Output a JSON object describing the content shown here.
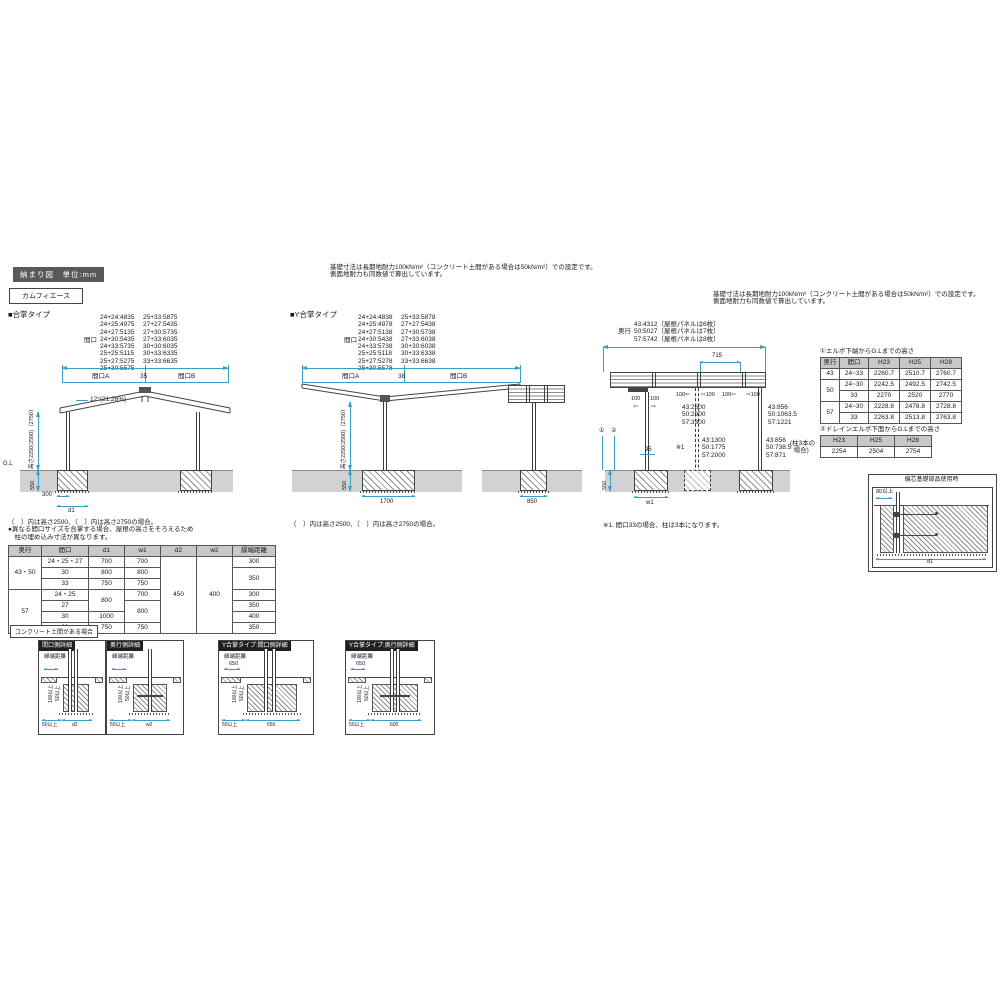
{
  "header": {
    "badge": "納まり図　単位:mm",
    "product": "カムフィエース"
  },
  "note_center": "基礎寸法は長期地耐力100kN/m²（コンクリート土間がある場合は50kN/m²）での設定です。\n側面地耐力も同数値で算出しています。",
  "note_right": "基礎寸法は長期地耐力100kN/m²（コンクリート土間がある場合は50kN/m²）での設定です。\n側面地耐力も同数値で算出しています。",
  "gassho": {
    "title": "■合掌タイプ",
    "maguchi": "間口",
    "col1": "24+24:4835\n24+25:4975\n24+27:5135\n24+30:5435\n24+33:5735\n25+25:5115\n25+27:5275\n25+30:5575",
    "col2": "25+33:5875\n27+27:5435\n27+30:5735\n27+33:6035\n30+30:6035\n30+33:6335\n33+33:6635",
    "span_a": "間口A",
    "gap": "35",
    "span_b": "間口B",
    "slope": "12°(21.26%)",
    "gl": "G.L",
    "height": "高さ2250(2500)〔2750〕",
    "d550": "550",
    "d300": "300",
    "d1": "d1",
    "note": "（　）内は高さ2500、〔　〕内は高さ2750の場合。\n●異なる間口サイズを合掌する場合、屋根の高さをそろえるため\n　柱の埋め込み寸法が異なります。"
  },
  "ygassho": {
    "title": "■Y合掌タイプ",
    "maguchi": "間口",
    "col1": "24+24:4838\n24+25:4978\n24+27:5138\n24+30:5438\n24+33:5738\n25+25:5118\n25+27:5278\n25+30:5578",
    "col2": "25+33:5878\n27+27:5438\n27+30:5738\n27+33:6038\n30+30:6038\n30+33:6338\n33+33:6638",
    "span_a": "間口A",
    "gap": "38",
    "span_b": "間口B",
    "height": "高さ2250(2500)〔2750〕",
    "d550": "550",
    "d1700": "1700",
    "d850": "850",
    "note": "（　）内は高さ2500、〔　〕内は高さ2750の場合。"
  },
  "depth": {
    "label": "奥行",
    "dims": "43:4312〔屋根パネルは6枚〕\n50:5027〔屋根パネルは7枚〕\n57:5742〔屋根パネルは8枚〕",
    "d715": "715",
    "a100l": "100",
    "a100r": "100",
    "arrow_l": "⇦",
    "arrow_r": "⇨",
    "joint1l": "100⇦",
    "joint1r": "⇨100",
    "joint2l": "100⇦",
    "joint2r": "⇨100",
    "span1": "43:2600\n50:2900\n57:3300",
    "post1": "43:856\n50:1063.5\n57:1221",
    "span2": "43:1300\n50:1775\n57:2000",
    "post2": "43:856\n50:738.5\n57:871",
    "three": "(柱3本の\n  場合)",
    "d95": "95",
    "ast": "※1",
    "ref1": "①",
    "ref2": "②",
    "d550": "550",
    "w1": "w1",
    "footnote": "※1. 間口33の場合、柱は3本になります。"
  },
  "table_elbow": {
    "title": "①エルボ下端からG.Lまでの高さ",
    "headers": [
      "奥行",
      "間口",
      "H23",
      "H25",
      "H28"
    ],
    "rows": [
      {
        "depth": "43",
        "span": "24~33",
        "h23": "2260.7",
        "h25": "2510.7",
        "h28": "2760.7"
      },
      {
        "depth": "50",
        "span": "24~30",
        "h23": "2242.5",
        "h25": "2492.5",
        "h28": "2742.5"
      },
      {
        "span": "33",
        "h23": "2270",
        "h25": "2520",
        "h28": "2770"
      },
      {
        "depth": "57",
        "span": "24~30",
        "h23": "2228.8",
        "h25": "2478.8",
        "h28": "2728.8"
      },
      {
        "span": "33",
        "h23": "2263.8",
        "h25": "2513.8",
        "h28": "2763.8"
      }
    ]
  },
  "table_drain": {
    "title": "②ドレインエルボ下面からG.Lまでの高さ",
    "headers": [
      "H23",
      "H25",
      "H28"
    ],
    "values": [
      "2254",
      "2504",
      "2754"
    ]
  },
  "ecc_box": {
    "title": "偏芯基礎部品使用時",
    "d80": "80以上",
    "d1": "d1"
  },
  "main_table": {
    "headers": [
      "奥行",
      "間口",
      "d1",
      "w1",
      "d2",
      "w2",
      "縁端距離"
    ],
    "r0": {
      "depth": "43・50",
      "span": "24・25・27",
      "d1": "700",
      "w1": "700",
      "d2": "450",
      "w2": "400",
      "edge": "300"
    },
    "r1": {
      "span": "30",
      "d1": "800",
      "w1": "800",
      "edge": "350"
    },
    "r2": {
      "span": "33",
      "d1": "750",
      "w1": "750"
    },
    "r3": {
      "depth": "57",
      "span": "24・25",
      "d1": "800",
      "w1": "700",
      "edge": "300"
    },
    "r4": {
      "span": "27",
      "w1": "800",
      "edge": "350"
    },
    "r5": {
      "span": "30",
      "d1": "1000",
      "edge": "400"
    },
    "r6": {
      "span": "33",
      "d1": "750",
      "w1": "750",
      "edge": "350"
    }
  },
  "concrete_label": "コンクリート土間がある場合",
  "details": {
    "common": {
      "edge": "縁端距離",
      "v100": "100以上",
      "v50": "50以上",
      "b50": "50以上"
    },
    "boxes": [
      {
        "title": "間口側詳細",
        "edge_val": "",
        "width": "d2"
      },
      {
        "title": "奥行側詳細",
        "edge_val": "",
        "width": "w2"
      },
      {
        "title": "Y合掌タイプ:間口側詳細",
        "edge_val": "650",
        "width": "650"
      },
      {
        "title": "Y合掌タイプ:奥行側詳細",
        "edge_val": "650",
        "width": "600"
      }
    ]
  }
}
